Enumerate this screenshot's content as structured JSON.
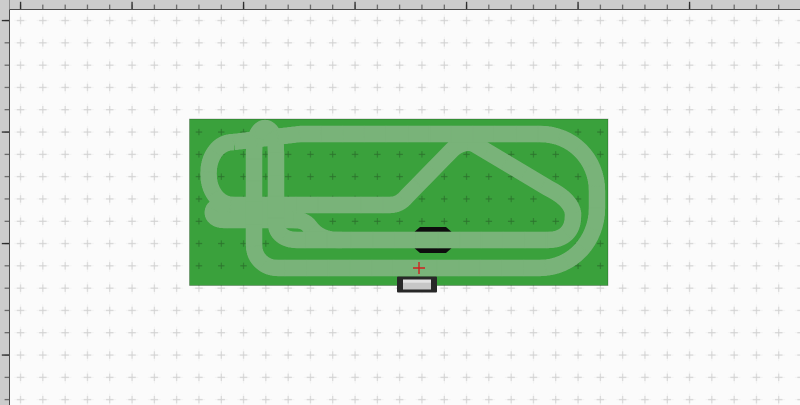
{
  "app": {
    "name": "track-layout-editor",
    "view": "design-canvas"
  },
  "colors": {
    "canvas_bg": "#fbfbfb",
    "grid_cross_light": "#c4c4c4",
    "grid_cross_faint": "#e2e2e2",
    "grid_cross_dark": "#1e4d1e",
    "ruler_bg": "#cccccc",
    "ruler_border": "#4a4a4a",
    "ruler_tick_minor": "#4c4c4c",
    "ruler_tick_major": "#2a2a2a",
    "board_green": "#3aa13c",
    "board_edge": "#2d7d2e",
    "track_edge": "#79b279",
    "track_body": "#0d0d0d",
    "track_lane_red": "#7d1517",
    "track_core": "#141414",
    "track_joint": "#c8c8c8",
    "powerbase_frame": "#282828",
    "powerbase_top": "#c6c6c6",
    "powerbase_highlight": "#e2e2e2",
    "marker_red": "#cf2020"
  },
  "ruler": {
    "orientation_top": "horizontal",
    "orientation_left": "vertical",
    "unit_spacing_px": 22.3,
    "major_every": 5
  },
  "board": {
    "label": "baseboard",
    "fill": "green"
  },
  "track": {
    "style": "slot-car-circuit",
    "lane_stripe": "dark-red",
    "pieces": {
      "lane_changer": "chicane-widening",
      "power_base": "connection-terminal",
      "insertion_marker": "red-cross"
    }
  }
}
